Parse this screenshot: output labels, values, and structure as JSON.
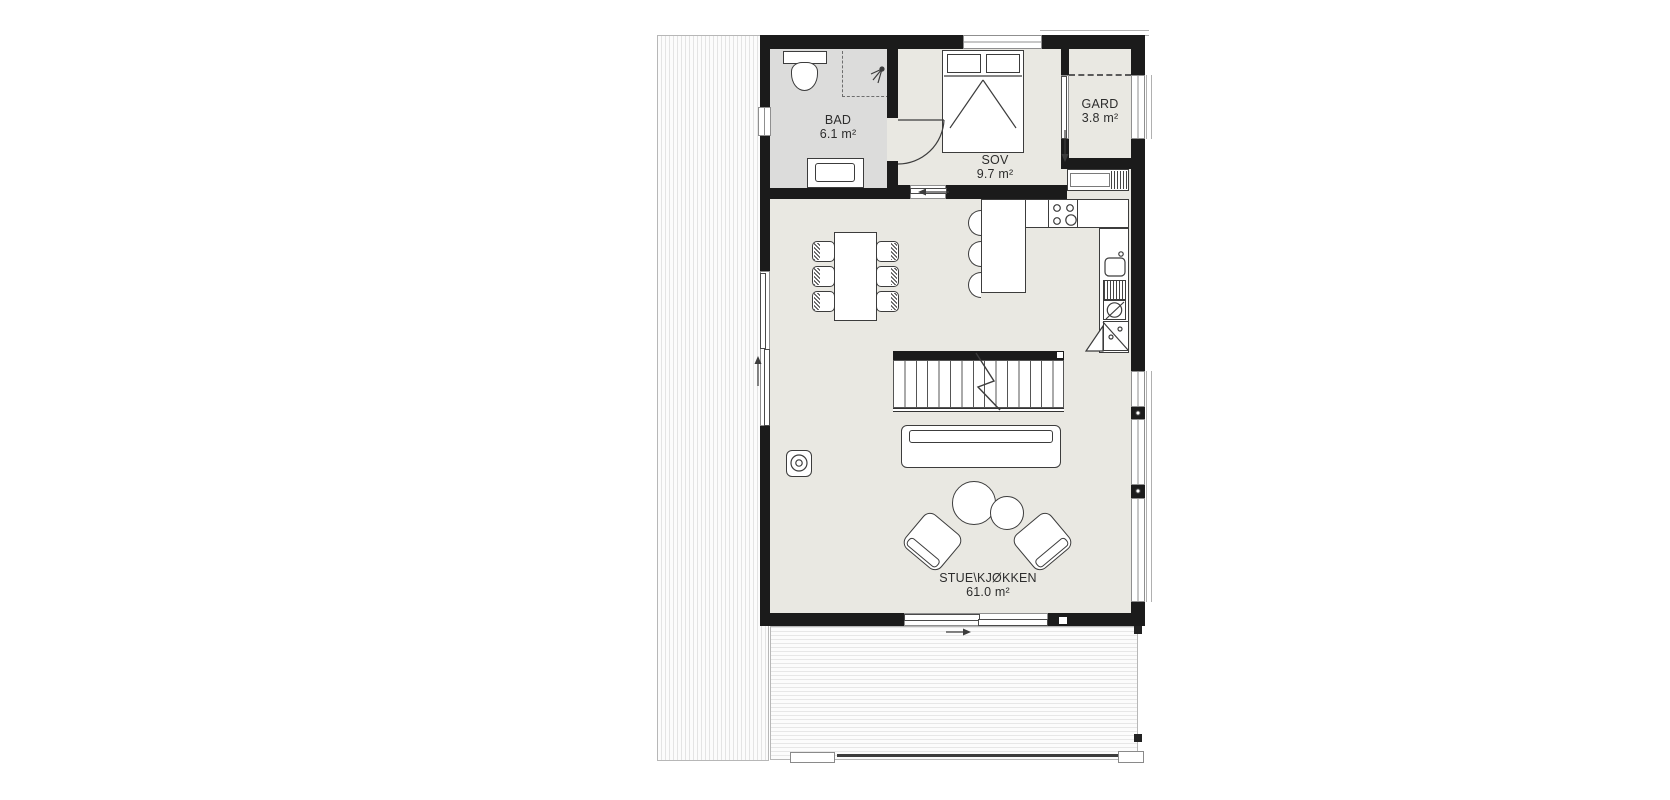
{
  "rooms": {
    "bad": {
      "name": "BAD",
      "area": "6.1 m²"
    },
    "sov": {
      "name": "SOV",
      "area": "9.7 m²"
    },
    "gard": {
      "name": "GARD",
      "area": "3.8 m²"
    },
    "stue": {
      "name": "STUE\\KJØKKEN",
      "area": "61.0 m²"
    }
  },
  "furniture": {
    "bathroom": [
      "toilet",
      "shower-corner",
      "vanity-basin"
    ],
    "bedroom": [
      "double-bed"
    ],
    "wardrobe": [
      "closet-dashed-front"
    ],
    "kitchen": [
      "tall-cabinet",
      "cooktop",
      "counter",
      "sink",
      "dishwasher",
      "corner-cabinet",
      "kitchen-island",
      "bar-stools"
    ],
    "living": [
      "dining-table",
      "dining-chairs",
      "staircase",
      "sofa",
      "coffee-tables",
      "lounge-chairs",
      "wood-stove"
    ],
    "outdoor": [
      "side-deck",
      "front-deck",
      "deck-railing"
    ]
  },
  "colors": {
    "wall": "#1b1b1b",
    "floor": "#e9e8e2",
    "bathroom_floor": "#dcdcdb",
    "furniture_outline": "#3c3c3c",
    "background": "#ffffff"
  }
}
